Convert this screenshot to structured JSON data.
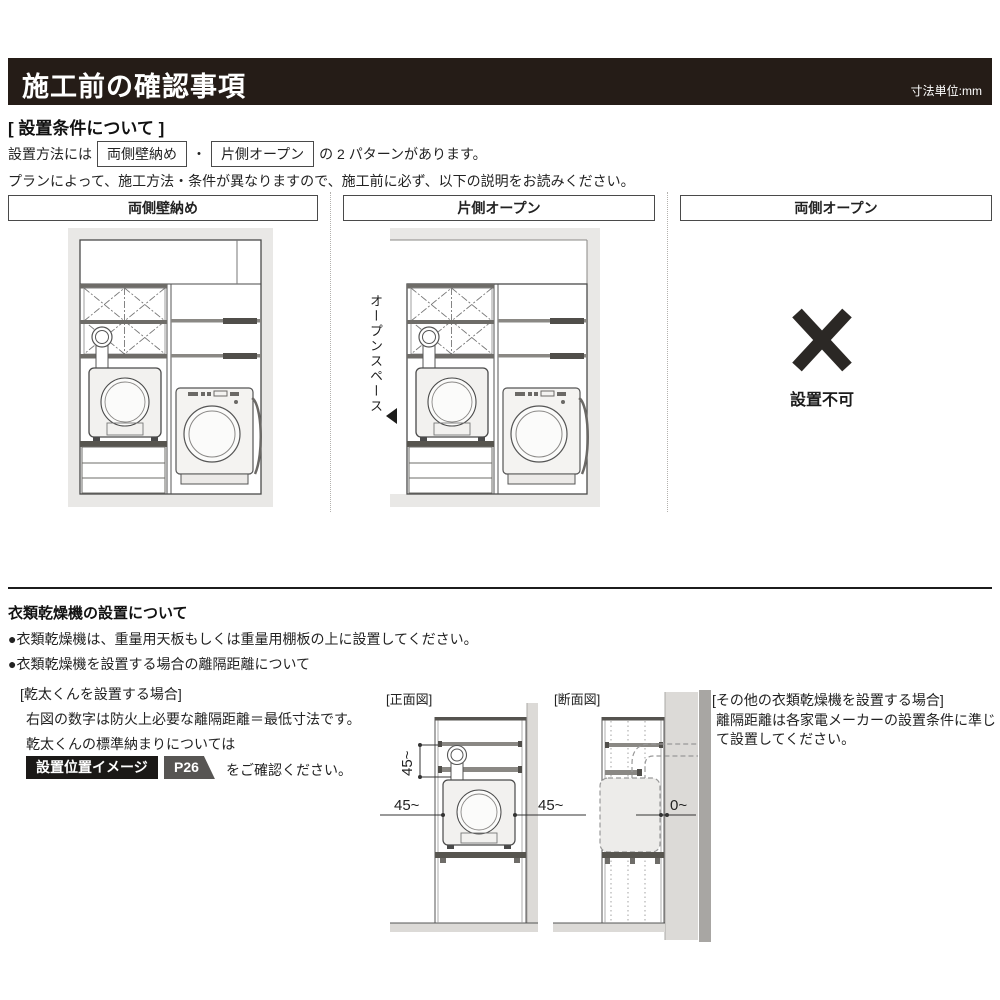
{
  "header": {
    "title": "施工前の確認事項",
    "units": "寸法単位:mm"
  },
  "setup": {
    "title": "[ 設置条件について ]",
    "intro_pre": "設置方法には",
    "pattern1": "両側壁納め",
    "intro_sep": "・",
    "pattern2": "片側オープン",
    "intro_post": "の 2 パターンがあります。",
    "note": "プランによって、施工方法・条件が異なりますので、施工前に必ず、以下の説明をお読みください。",
    "columns": [
      {
        "header": "両側壁納め"
      },
      {
        "header": "片側オープン",
        "annotation": "オープンスペース"
      },
      {
        "header": "両側オープン",
        "caption": "設置不可"
      }
    ]
  },
  "dryer": {
    "title": "衣類乾燥機の設置について",
    "bullet1": "●衣類乾燥機は、重量用天板もしくは重量用棚板の上に設置してください。",
    "bullet2": "●衣類乾燥機を設置する場合の離隔距離について",
    "kanta_heading": "[乾太くんを設置する場合]",
    "kanta_line1": "右図の数字は防火上必要な離隔距離＝最低寸法です。",
    "kanta_line2": "乾太くんの標準納まりについては",
    "badge_image": "設置位置イメージ",
    "badge_page": "P26",
    "kanta_line3": "をご確認ください。",
    "front_view_label": "[正面図]",
    "front_dim_vertical": "45~",
    "front_dim_left": "45~",
    "front_dim_right": "45~",
    "section_view_label": "[断面図]",
    "section_dim": "0~",
    "other_heading": "[その他の衣類乾燥機を設置する場合]",
    "other_body": "離隔距離は各家電メーカーの設置条件に準じて設置してください。"
  },
  "colors": {
    "header_bg": "#251c17",
    "badge_black": "#1b1917",
    "badge_gray": "#575553",
    "wall_gray": "#dcdad7",
    "frame_gray": "#e9e8e6",
    "line_dark": "#4a4a4a"
  }
}
